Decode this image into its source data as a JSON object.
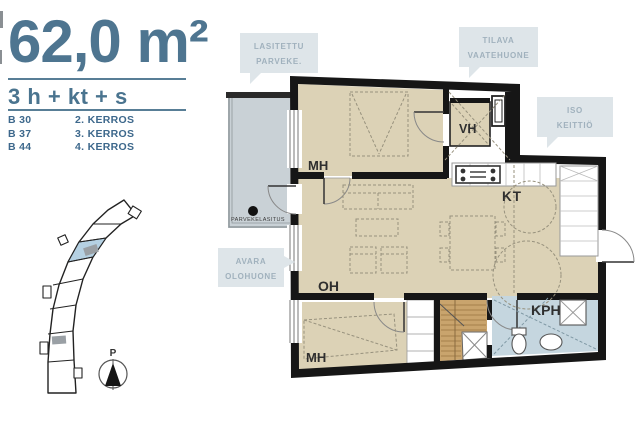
{
  "panel": {
    "area": "62,0 m²",
    "layout": "3 h + kt + s",
    "units": [
      {
        "code": "B 30",
        "floor": "2. KERROS"
      },
      {
        "code": "B 37",
        "floor": "3. KERROS"
      },
      {
        "code": "B 44",
        "floor": "4. KERROS"
      }
    ]
  },
  "callouts": [
    {
      "line1": "LASITETTU",
      "line2": "PARVEKE."
    },
    {
      "line1": "TILAVA",
      "line2": "VAATEHUONE"
    },
    {
      "line1": "ISO",
      "line2": "KEITTIÖ"
    },
    {
      "line1": "AVARA",
      "line2": "OLOHUONE"
    }
  ],
  "rooms": {
    "bedroom1": "MH",
    "closet": "VH",
    "kitchen": "KT",
    "living": "OH",
    "bedroom2": "MH",
    "bathroom": "KPH"
  },
  "plan_notes": {
    "balcony_glazing": "PARVEKELASITUS",
    "north": "P"
  },
  "colors": {
    "accent_slate": "#4e7590",
    "callout_bg": "#dee5e9",
    "callout_text": "#a0b1bd",
    "floor_beige": "#dcd2b6",
    "balcony_gray": "#c9d1d6",
    "bathroom_blue": "#c5d6df",
    "sauna_wood": "#c9a46d",
    "wall_black": "#161616",
    "site_highlight": "#b5d1e3"
  }
}
